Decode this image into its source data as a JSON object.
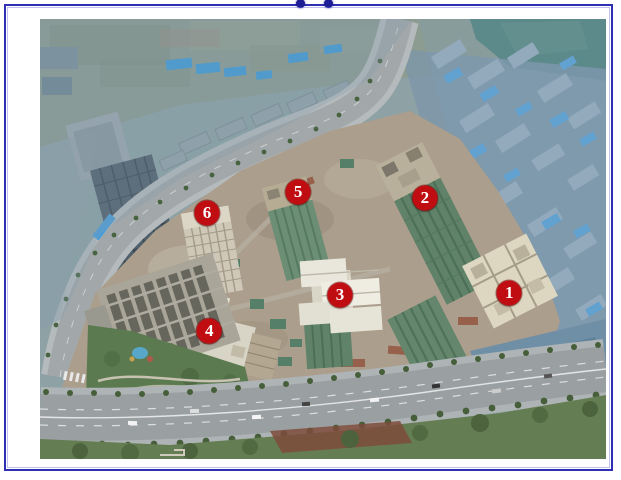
{
  "figure": {
    "type": "annotated-aerial-construction-photo",
    "markers": [
      {
        "label": "1",
        "x_pct": 82.9,
        "y_pct": 62.3
      },
      {
        "label": "2",
        "x_pct": 68.0,
        "y_pct": 40.7
      },
      {
        "label": "3",
        "x_pct": 53.0,
        "y_pct": 62.7
      },
      {
        "label": "4",
        "x_pct": 29.9,
        "y_pct": 70.9
      },
      {
        "label": "5",
        "x_pct": 45.6,
        "y_pct": 39.3
      },
      {
        "label": "6",
        "x_pct": 29.5,
        "y_pct": 44.1
      }
    ],
    "handle_dots_x_px": [
      290,
      318
    ],
    "colors": {
      "border": "#2f2fb4",
      "handle_dot": "#1d1d96",
      "marker_fill": "#c00d12",
      "marker_text": "#ffffff"
    }
  }
}
